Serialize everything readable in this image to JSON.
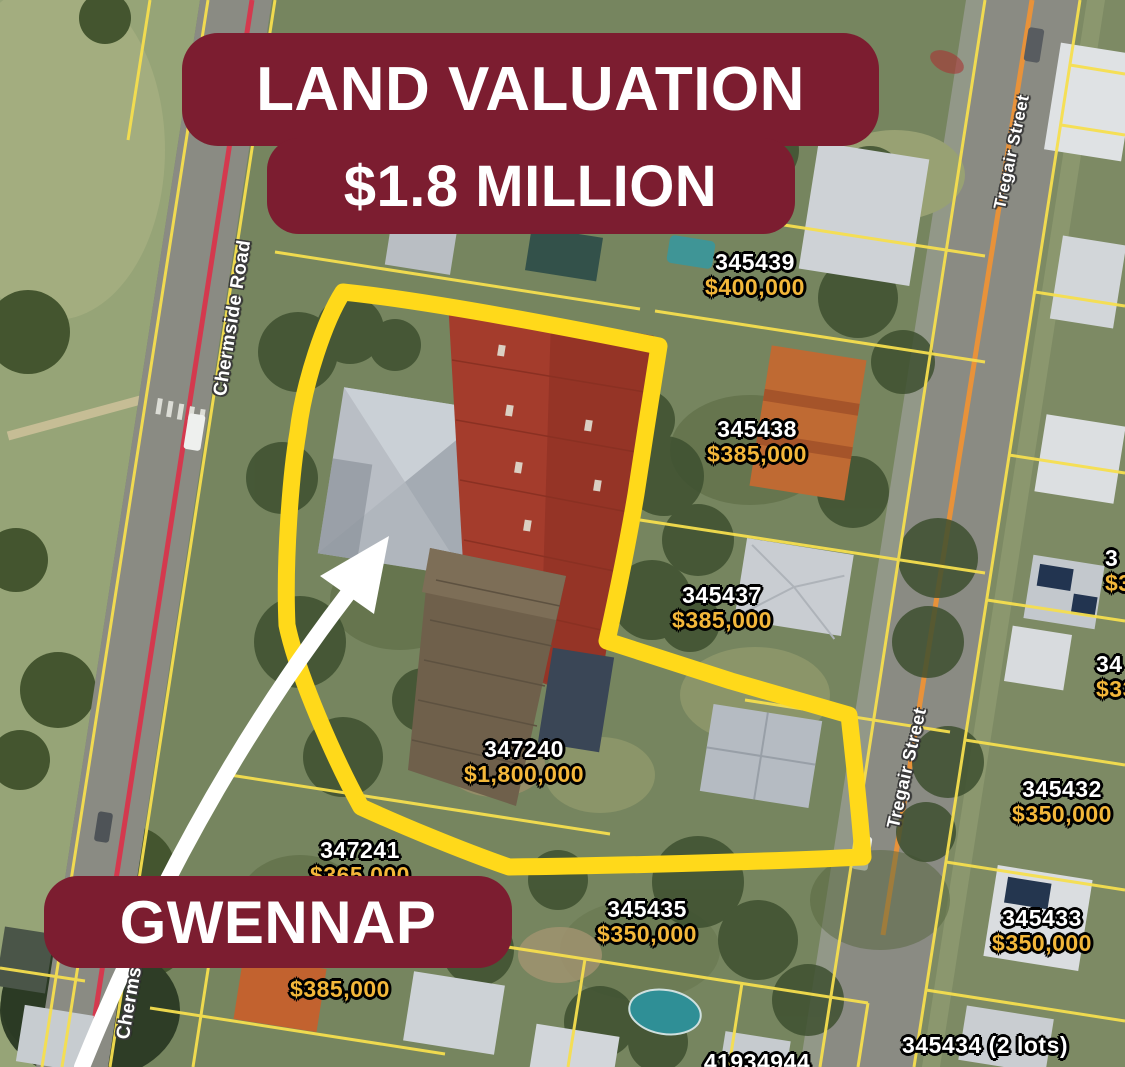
{
  "banners": {
    "valuation_line1": "LAND VALUATION",
    "valuation_line2": "$1.8 MILLION",
    "property_name": "GWENNAP"
  },
  "streets": {
    "chermside": "Chermside Road",
    "chermside_partial": "Cherms",
    "tregair_top": "Tregair Street",
    "tregair_mid": "Tregair Street"
  },
  "lots": [
    {
      "id": "345439",
      "value": "$400,000"
    },
    {
      "id": "345438",
      "value": "$385,000"
    },
    {
      "id": "345437",
      "value": "$385,000"
    },
    {
      "id": "347240",
      "value": "$1,800,000"
    },
    {
      "id": "347241",
      "value": "$365,000"
    },
    {
      "id": "345435",
      "value": "$350,000"
    },
    {
      "id": "345432",
      "value": "$350,000"
    },
    {
      "id": "345433",
      "value": "$350,000"
    },
    {
      "id": "345434 (2 lots)",
      "value": ""
    },
    {
      "id": "41934944",
      "value": ""
    },
    {
      "id": "",
      "value": "$385,000"
    },
    {
      "id": "34",
      "value": "$33"
    },
    {
      "id": "3",
      "value": "$3"
    }
  ],
  "colors": {
    "banner": "#7c1d30",
    "highlight_marker": "#ffd91a",
    "cadastral_line": "#f6de4e",
    "price_text": "#f3b73a",
    "lot_id_text": "#ffffff",
    "chermside_centerline": "#d4394e",
    "tregair_centerline": "#e8923a",
    "arrow": "#ffffff"
  }
}
